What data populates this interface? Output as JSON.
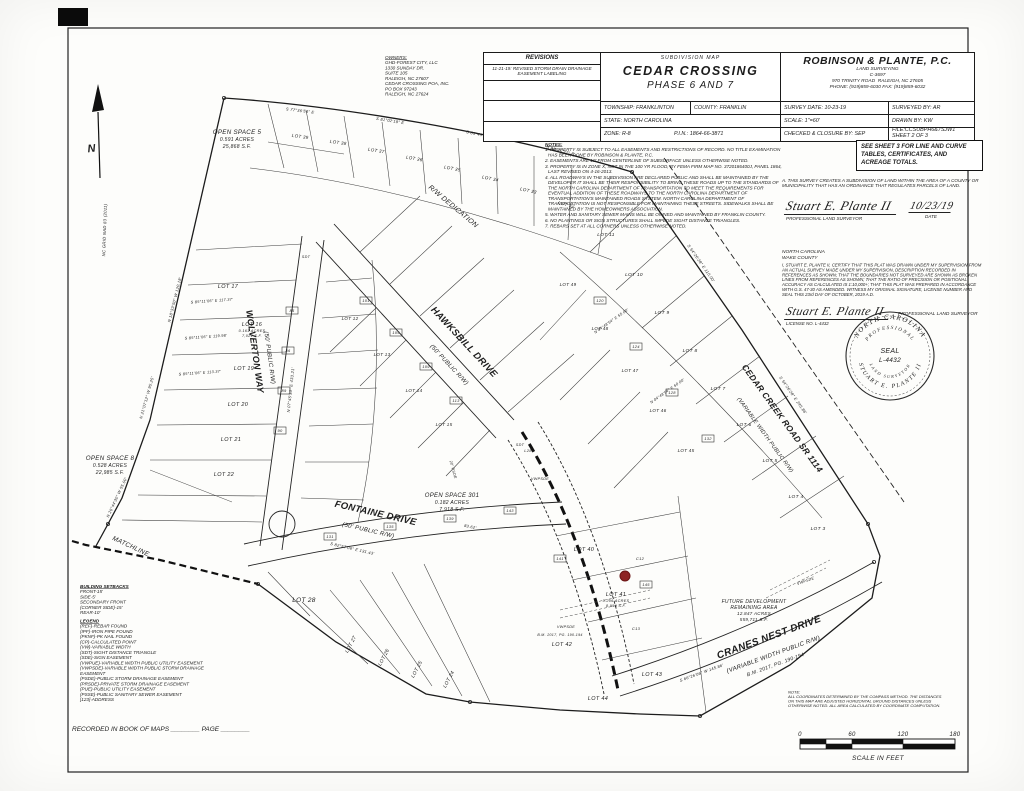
{
  "title_block": {
    "revisions_header": "REVISIONS",
    "revision_entry": "11-21-19: REVISED STORM DRAIN DRAINAGE EASEMENT LABELING",
    "map_type": "SUBDIVISION MAP",
    "title": "CEDAR CROSSING",
    "phase": "PHASE 6 AND 7",
    "township": "TOWNSHIP: FRANKLINTON",
    "county": "COUNTY: FRANKLIN",
    "state": "STATE: NORTH CAROLINA",
    "zone": "ZONE: R-8",
    "pin": "P.I.N.: 1864-66-3871",
    "firm_name": "ROBINSON & PLANTE, P.C.",
    "firm_sub": "LAND SURVEYING",
    "firm_license": "C-3697",
    "firm_addr1": "970 TRINITY ROAD",
    "firm_addr2": "RALEIGH, NC 27605",
    "firm_phone": "PHONE: (919)859-6030   FAX: (919)859-6032",
    "survey_date": "SURVEY DATE: 10-23-19",
    "surveyed_by": "SURVEYED BY: AR",
    "scale": "SCALE: 1\"=60'",
    "drawn_by": "DRAWN BY: KW",
    "checked": "CHECKED & CLOSURE BY: SEP",
    "file": "FILE:CCSUBPH6&7SJW1",
    "sheet": "SHEET 2 OF 3"
  },
  "owners": {
    "heading": "OWNERS:",
    "lines": [
      "GHD-FOREST CITY, LLC",
      "1330 SUNDAY DR.",
      "SUITE 105",
      "RALEIGH, NC 27607",
      " ",
      "CEDAR CROSSING POA, INC.",
      "PO BOX 97243",
      "RALEIGH, NC 27624"
    ]
  },
  "notes": {
    "heading": "NOTES:",
    "items": [
      "1. PROPERTY IS SUBJECT TO ALL EASEMENTS AND RESTRICTIONS OF RECORD. NO TITLE EXAMINATION HAS BEEN DONE BY ROBINSON & PLANTE, P.C.",
      "2. EASEMENTS ARE 10' FROM CENTERLINE OF SUBSURFACE UNLESS OTHERWISE NOTED.",
      "3. PROPERTY IS IN ZONE X, NOT IN THE 100 YR FLOOD, BY FEMA FIRM MAP NO. 3720186400J, PANEL 1864, LAST REVISED ON 4-16-2013.",
      "4. ALL ROADWAYS IN THE SUBDIVISION ARE DECLARED PUBLIC AND SHALL BE MAINTAINED BY THE DEVELOPER IT SHALL BE THEIR RESPONSIBILITY TO BRING THESE ROADS UP TO THE STANDARDS OF THE NORTH CAROLINA DEPARTMENT OF TRANSPORTATION TO MEET THE REQUIREMENTS FOR EVENTUAL ADDITION OF THESE ROADWAYS TO THE NORTH CAROLINA DEPARTMENT OF TRANSPORTATION'S MAINTAINED ROADS SYSTEM. NORTH CAROLINA DEPARTMENT OF TRANSPORTATION IS NOT RESPONSIBLE FOR MAINTAINING THESE STREETS. SIDEWALKS SHALL BE MAINTAINED BY THE HOMEOWNERS ASSOCIATION.",
      "5. WATER AND SANITARY SEWER MAINS WILL BE OWNED AND MAINTAINED BY FRANKLIN COUNTY.",
      "6. NO PLANTINGS OR SIGN STRUCTURES SHALL IMPEDE SIGHT DISTANCE TRIANGLES.",
      "7. REBARS SET AT ALL CORNERS UNLESS OTHERWISE NOTED."
    ]
  },
  "see_sheet_note": "SEE SHEET 3 FOR LINE AND CURVE TABLES, CERTIFICATES, AND ACREAGE TOTALS.",
  "certificates": {
    "cert_a": "A. THIS SURVEY CREATES A SUBDIVISION OF LAND WITHIN THE AREA OF A COUNTY OR MUNICIPALITY THAT HAS AN ORDINANCE THAT REGULATES PARCELS OF LAND.",
    "signature1": "Stuart E. Plante II",
    "signature1_title": "PROFESSIONAL LAND SURVEYOR",
    "date_value": "10/23/19",
    "date_label": "DATE",
    "state_line": "NORTH CAROLINA",
    "county_line": "WAKE COUNTY",
    "cert_b": "I, STUART E. PLANTE II, CERTIFY THAT THIS PLAT WAS DRAWN UNDER MY SUPERVISION FROM AN ACTUAL SURVEY MADE UNDER MY SUPERVISION, DESCRIPTION RECORDED IN REFERENCES AS SHOWN; THAT THE BOUNDARIES NOT SURVEYED ARE SHOWN AS BROKEN LINES FROM REFERENCES AS SHOWN; THAT THE RATIO OF PRECISION OR POSITIONAL ACCURACY AS CALCULATED IS 1:10,000+; THAT THIS PLAT WAS PREPARED IN ACCORDANCE WITH G.S. 47-30 AS AMENDED. WITNESS MY ORIGINAL SIGNATURE, LICENSE NUMBER AND SEAL THIS 23rd DAY OF OCTOBER, 2019 A.D.",
    "signature2": "Stuart E. Plante II",
    "signature2_license": "LICENSE NO. L-4432",
    "signature2_title": "PROFESSIONAL LAND SURVEYOR"
  },
  "seal": {
    "arc_top": "NORTH CAROLINA",
    "arc_top_inner": "PROFESSIONAL",
    "center1": "SEAL",
    "center2": "L-4432",
    "arc_bottom": "STUART E. PLANTE II",
    "arc_bottom_inner": "LAND SURVEYOR"
  },
  "north_arrow": {
    "label": "N",
    "sub": "NC GRID NAD 83 (2011)"
  },
  "setbacks": {
    "heading": "BUILDING SETBACKS",
    "items": [
      "FRONT-15'",
      "SIDE-5'",
      "SECONDARY FRONT",
      "(CORNER SIDE)-15'",
      "REAR-10'"
    ]
  },
  "legend": {
    "heading": "LEGEND",
    "items": [
      "(REF)-REBAR FOUND",
      "(IPF)-IRON PIPE FOUND",
      "(PKNF)-PK NAIL FOUND",
      "(CP)-CALCULATED POINT",
      "(VW)-VARIABLE WIDTH",
      "(SDT)-SIGHT DISTANCE TRIANGLE",
      "(SDE)-SIGN EASEMENT",
      "(VWPUE)-VARIABLE WIDTH PUBLIC UTILITY EASEMENT",
      "(VWPSDE)-VARIABLE WIDTH PUBLIC STORM DRAINAGE EASEMENT",
      "(PSDE)-PUBLIC STORM DRAINAGE EASEMENT",
      "(PRSDE)-PRIVATE STORM DRAINAGE EASEMENT",
      "(PUE)-PUBLIC UTILITY EASEMENT",
      "(PSSE)-PUBLIC SANITARY SEWER EASEMENT",
      "[123]-ADDRESS"
    ]
  },
  "recorded_line": "RECORDED IN BOOK OF MAPS ________  PAGE ________",
  "scale_bar": {
    "note_lines": [
      "NOTE:",
      "ALL COORDINATES DETERMINED BY THE COMPASS METHOD. THE DISTANCES",
      "ON THIS MAP ARE ADJUSTED HORIZONTAL GROUND DISTANCES UNLESS",
      "OTHERWISE NOTED. ALL AREA CALCULATED BY COORDINATE COMPUTATION."
    ],
    "ticks": [
      "0",
      "60",
      "120",
      "180"
    ],
    "caption": "SCALE IN FEET"
  },
  "colors": {
    "ink": "#1c1c1c",
    "red_dot": "#8e2323",
    "paper": "#fdfdfb"
  },
  "plat": {
    "red_marker": "red-location-dot",
    "labels": [
      {
        "t": "HAWKSBILL DRIVE",
        "x": 462,
        "y": 344,
        "r": 47,
        "s": 9.5,
        "b": 1
      },
      {
        "t": "(50' PUBLIC R/W)",
        "x": 448,
        "y": 366,
        "r": 47,
        "s": 6
      },
      {
        "t": "WOLVERTON WAY",
        "x": 252,
        "y": 352,
        "r": 82,
        "s": 9,
        "b": 1
      },
      {
        "t": "(50' PUBLIC R/W)",
        "x": 268,
        "y": 358,
        "r": 82,
        "s": 6
      },
      {
        "t": "FONTAINE DRIVE",
        "x": 375,
        "y": 516,
        "r": 13,
        "s": 9.5,
        "b": 1
      },
      {
        "t": "(50' PUBLIC R/W)",
        "x": 368,
        "y": 532,
        "r": 13,
        "s": 6
      },
      {
        "t": "CEDAR CREEK ROAD SR 1114",
        "x": 780,
        "y": 420,
        "r": 54,
        "s": 8.5,
        "b": 1
      },
      {
        "t": "(VARIABLE WIDTH PUBLIC R/W)",
        "x": 764,
        "y": 436,
        "r": 54,
        "s": 5.5
      },
      {
        "t": "CRANES NEST DRIVE",
        "x": 770,
        "y": 640,
        "r": -20,
        "s": 10,
        "b": 1
      },
      {
        "t": "(VARIABLE WIDTH PUBLIC R/W)",
        "x": 774,
        "y": 656,
        "r": -20,
        "s": 6
      },
      {
        "t": "B.M. 2017, PG. 190-194",
        "x": 776,
        "y": 666,
        "r": -20,
        "s": 5
      },
      {
        "t": "R/W DEDICATION",
        "x": 452,
        "y": 208,
        "r": 40,
        "s": 7
      },
      {
        "t": "MATCHLINE",
        "x": 130,
        "y": 548,
        "r": 25,
        "s": 6.5
      },
      {
        "t": "OPEN SPACE 5",
        "x": 237,
        "y": 134,
        "s": 6.2
      },
      {
        "t": "0.591 ACRES",
        "x": 237,
        "y": 141,
        "s": 5
      },
      {
        "t": "25,868 S.F.",
        "x": 237,
        "y": 148,
        "s": 5
      },
      {
        "t": "OPEN SPACE 8",
        "x": 110,
        "y": 460,
        "s": 6.2
      },
      {
        "t": "0.528 ACRES",
        "x": 110,
        "y": 467,
        "s": 5
      },
      {
        "t": "22,985 S.F.",
        "x": 110,
        "y": 474,
        "s": 5
      },
      {
        "t": "OPEN SPACE 301",
        "x": 452,
        "y": 497,
        "s": 6
      },
      {
        "t": "0.182 ACRES",
        "x": 452,
        "y": 504,
        "s": 5
      },
      {
        "t": "7,918 S.F.",
        "x": 452,
        "y": 511,
        "s": 5
      },
      {
        "t": "FUTURE DEVELOPMENT",
        "x": 754,
        "y": 603,
        "s": 5
      },
      {
        "t": "REMAINING AREA",
        "x": 754,
        "y": 609,
        "s": 5
      },
      {
        "t": "12.847 ACRES",
        "x": 754,
        "y": 615,
        "s": 4.5
      },
      {
        "t": "559,711 S.F.",
        "x": 754,
        "y": 621,
        "s": 4.5
      },
      {
        "t": "LOT 17",
        "x": 228,
        "y": 288,
        "s": 5.5
      },
      {
        "t": "LOT 16",
        "x": 252,
        "y": 326,
        "s": 5.5
      },
      {
        "t": "0.161 ACRES",
        "x": 252,
        "y": 332,
        "s": 3.8
      },
      {
        "t": "7,021 S.F.",
        "x": 252,
        "y": 337,
        "s": 3.8
      },
      {
        "t": "LOT 19",
        "x": 244,
        "y": 370,
        "s": 5.5
      },
      {
        "t": "LOT 20",
        "x": 238,
        "y": 406,
        "s": 5.5
      },
      {
        "t": "LOT 21",
        "x": 231,
        "y": 441,
        "s": 5.5
      },
      {
        "t": "LOT 22",
        "x": 224,
        "y": 476,
        "s": 5.5
      },
      {
        "t": "LOT 28",
        "x": 304,
        "y": 602,
        "s": 6.5
      },
      {
        "t": "LOT 40",
        "x": 584,
        "y": 551,
        "s": 5.5
      },
      {
        "t": "LOT 41",
        "x": 616,
        "y": 596,
        "s": 5.5
      },
      {
        "t": "0.206 ACRES",
        "x": 616,
        "y": 602,
        "s": 3.8
      },
      {
        "t": "8,956 S.F.",
        "x": 616,
        "y": 607,
        "s": 3.8
      },
      {
        "t": "LOT 42",
        "x": 562,
        "y": 646,
        "s": 5.5
      },
      {
        "t": "LOT 43",
        "x": 652,
        "y": 676,
        "s": 5.5
      },
      {
        "t": "LOT 44",
        "x": 598,
        "y": 700,
        "s": 5.5
      },
      {
        "t": "LOT 27",
        "x": 352,
        "y": 645,
        "r": -62,
        "s": 5
      },
      {
        "t": "LOT 26",
        "x": 385,
        "y": 658,
        "r": -62,
        "s": 5
      },
      {
        "t": "LOT 25",
        "x": 418,
        "y": 670,
        "r": -62,
        "s": 5
      },
      {
        "t": "LOT 24",
        "x": 450,
        "y": 680,
        "r": -62,
        "s": 5
      },
      {
        "t": "LOT 11",
        "x": 606,
        "y": 236,
        "s": 4.8
      },
      {
        "t": "LOT 10",
        "x": 634,
        "y": 276,
        "s": 4.8
      },
      {
        "t": "LOT 9",
        "x": 662,
        "y": 314,
        "s": 4.8
      },
      {
        "t": "LOT 8",
        "x": 690,
        "y": 352,
        "s": 4.8
      },
      {
        "t": "LOT 7",
        "x": 718,
        "y": 390,
        "s": 4.8
      },
      {
        "t": "LOT 6",
        "x": 744,
        "y": 426,
        "s": 4.8
      },
      {
        "t": "LOT 5",
        "x": 770,
        "y": 462,
        "s": 4.8
      },
      {
        "t": "LOT 4",
        "x": 796,
        "y": 498,
        "s": 4.8
      },
      {
        "t": "LOT 3",
        "x": 818,
        "y": 530,
        "s": 4.8
      },
      {
        "t": "LOT 49",
        "x": 568,
        "y": 286,
        "s": 4.5
      },
      {
        "t": "LOT 48",
        "x": 600,
        "y": 330,
        "s": 4.5
      },
      {
        "t": "LOT 47",
        "x": 630,
        "y": 372,
        "s": 4.5
      },
      {
        "t": "LOT 46",
        "x": 658,
        "y": 412,
        "s": 4.5
      },
      {
        "t": "LOT 45",
        "x": 686,
        "y": 452,
        "s": 4.5
      },
      {
        "t": "LOT 39",
        "x": 300,
        "y": 138,
        "r": 8,
        "s": 4.5
      },
      {
        "t": "LOT 38",
        "x": 338,
        "y": 144,
        "r": 8,
        "s": 4.5
      },
      {
        "t": "LOT 37",
        "x": 376,
        "y": 152,
        "r": 9,
        "s": 4.5
      },
      {
        "t": "LOT 36",
        "x": 414,
        "y": 160,
        "r": 10,
        "s": 4.5
      },
      {
        "t": "LOT 35",
        "x": 452,
        "y": 170,
        "r": 11,
        "s": 4.5
      },
      {
        "t": "LOT 34",
        "x": 490,
        "y": 180,
        "r": 12,
        "s": 4.5
      },
      {
        "t": "LOT 33",
        "x": 528,
        "y": 192,
        "r": 13,
        "s": 4.5
      },
      {
        "t": "LOT 32",
        "x": 566,
        "y": 206,
        "r": 14,
        "s": 4.5
      },
      {
        "t": "LOT 12",
        "x": 350,
        "y": 320,
        "s": 4.5
      },
      {
        "t": "LOT 13",
        "x": 382,
        "y": 356,
        "s": 4.5
      },
      {
        "t": "LOT 14",
        "x": 414,
        "y": 392,
        "s": 4.5
      },
      {
        "t": "LOT 15",
        "x": 444,
        "y": 426,
        "s": 4.5
      },
      {
        "t": "N 18°33'50\" W  120.18'",
        "x": 176,
        "y": 300,
        "r": -76,
        "s": 4
      },
      {
        "t": "N 21°07'12\" W  95.25'",
        "x": 148,
        "y": 398,
        "r": -74,
        "s": 4
      },
      {
        "t": "N 26°44'30\" W  55.00'",
        "x": 118,
        "y": 498,
        "r": -65,
        "s": 4
      },
      {
        "t": "S 77°36'54\" E",
        "x": 300,
        "y": 112,
        "r": 7,
        "s": 4
      },
      {
        "t": "S 81°02'18\" E",
        "x": 390,
        "y": 122,
        "r": 9,
        "s": 4
      },
      {
        "t": "S 85°45'00\" E",
        "x": 480,
        "y": 136,
        "r": 12,
        "s": 4
      },
      {
        "t": "S 88°10'37\" E",
        "x": 560,
        "y": 152,
        "r": 15,
        "s": 4
      },
      {
        "t": "S 54°26'28\" E  110.00'",
        "x": 700,
        "y": 264,
        "r": 55,
        "s": 4
      },
      {
        "t": "S 54°26'28\" E  245.86'",
        "x": 792,
        "y": 396,
        "r": 55,
        "s": 4
      },
      {
        "t": "N 07°45'33\" E  433.21'",
        "x": 292,
        "y": 390,
        "r": -84,
        "s": 4
      },
      {
        "t": "S 82°57'06\" E  131.43'",
        "x": 352,
        "y": 550,
        "r": 13,
        "s": 4
      },
      {
        "t": "83.62'",
        "x": 470,
        "y": 528,
        "r": 12,
        "s": 4
      },
      {
        "t": "S 66°26'06\" W  145.86'",
        "x": 702,
        "y": 674,
        "r": -20,
        "s": 4
      },
      {
        "t": "L28",
        "x": 528,
        "y": 452,
        "s": 4
      },
      {
        "t": "C12",
        "x": 640,
        "y": 560,
        "s": 4
      },
      {
        "t": "C13",
        "x": 636,
        "y": 630,
        "s": 4
      },
      {
        "t": "VWPSDE",
        "x": 540,
        "y": 480,
        "s": 3.8
      },
      {
        "t": "VWPSDE",
        "x": 566,
        "y": 628,
        "s": 3.8
      },
      {
        "t": "VWPSDE",
        "x": 806,
        "y": 582,
        "r": -20,
        "s": 3.8
      },
      {
        "t": "SDT",
        "x": 306,
        "y": 258,
        "s": 3.8
      },
      {
        "t": "SDT",
        "x": 520,
        "y": 446,
        "s": 3.8
      },
      {
        "t": "20' PSDE",
        "x": 452,
        "y": 470,
        "r": 75,
        "s": 3.8
      },
      {
        "t": "S 85°11'06\" E  117.37'",
        "x": 212,
        "y": 302,
        "r": -4,
        "s": 3.8
      },
      {
        "t": "S 85°11'06\" E  119.98'",
        "x": 206,
        "y": 338,
        "r": -4,
        "s": 3.8
      },
      {
        "t": "S 85°11'06\" E  113.37'",
        "x": 200,
        "y": 374,
        "r": -4,
        "s": 3.8
      },
      {
        "t": "N 04°48'54\" E  55.00'",
        "x": 612,
        "y": 322,
        "r": -35,
        "s": 3.8
      },
      {
        "t": "N 04°48'54\" E  60.00'",
        "x": 668,
        "y": 392,
        "r": -35,
        "s": 3.8
      },
      {
        "t": "B.M. 2017, PG. 190-194",
        "x": 560,
        "y": 636,
        "s": 3.6
      },
      {
        "t": "85",
        "x": 292,
        "y": 312,
        "s": 4,
        "box": 1
      },
      {
        "t": "86",
        "x": 288,
        "y": 352,
        "s": 4,
        "box": 1
      },
      {
        "t": "89",
        "x": 284,
        "y": 392,
        "s": 4,
        "box": 1
      },
      {
        "t": "90",
        "x": 280,
        "y": 432,
        "s": 4,
        "box": 1
      },
      {
        "t": "101",
        "x": 366,
        "y": 302,
        "s": 4,
        "box": 1
      },
      {
        "t": "105",
        "x": 396,
        "y": 334,
        "s": 4,
        "box": 1
      },
      {
        "t": "109",
        "x": 426,
        "y": 368,
        "s": 4,
        "box": 1
      },
      {
        "t": "113",
        "x": 456,
        "y": 402,
        "s": 4,
        "box": 1
      },
      {
        "t": "131",
        "x": 330,
        "y": 538,
        "s": 4,
        "box": 1
      },
      {
        "t": "135",
        "x": 390,
        "y": 528,
        "s": 4,
        "box": 1
      },
      {
        "t": "139",
        "x": 450,
        "y": 520,
        "s": 4,
        "box": 1
      },
      {
        "t": "143",
        "x": 510,
        "y": 512,
        "s": 4,
        "box": 1
      },
      {
        "t": "120",
        "x": 600,
        "y": 302,
        "s": 4,
        "box": 1
      },
      {
        "t": "124",
        "x": 636,
        "y": 348,
        "s": 4,
        "box": 1
      },
      {
        "t": "128",
        "x": 672,
        "y": 394,
        "s": 4,
        "box": 1
      },
      {
        "t": "132",
        "x": 708,
        "y": 440,
        "s": 4,
        "box": 1
      },
      {
        "t": "141",
        "x": 560,
        "y": 560,
        "s": 4,
        "box": 1
      },
      {
        "t": "145",
        "x": 646,
        "y": 586,
        "s": 4,
        "box": 1
      }
    ]
  }
}
